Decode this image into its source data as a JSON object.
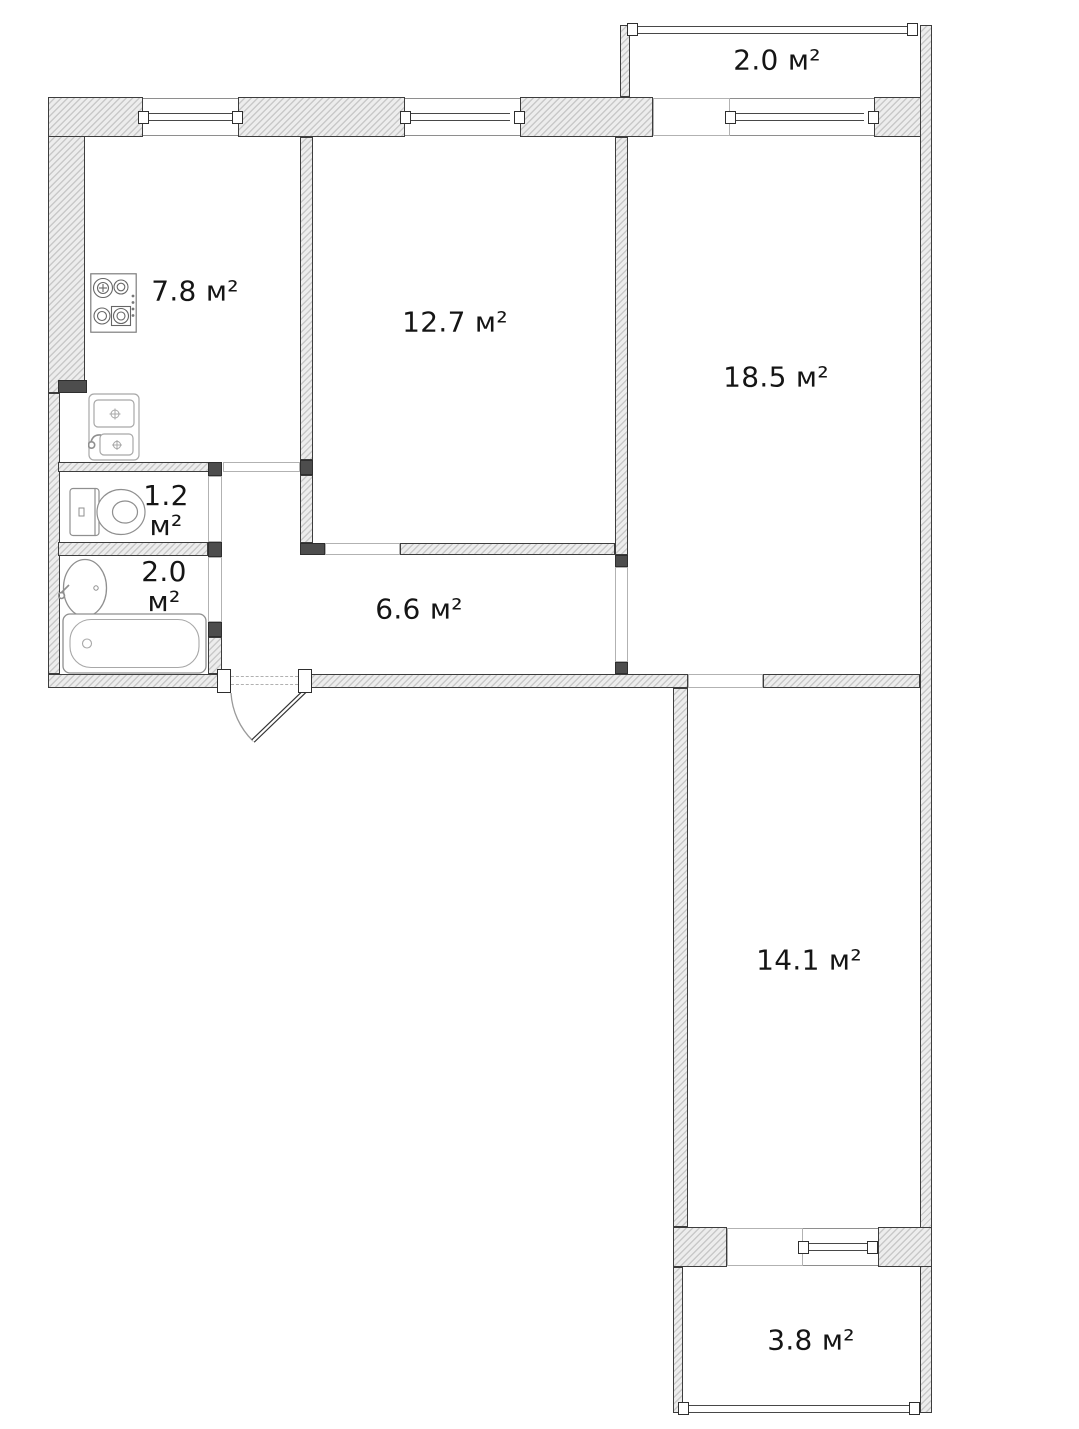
{
  "plan": {
    "kind": "apartment-floor-plan",
    "area_unit": "м²"
  },
  "rooms": [
    {
      "id": "kitchen",
      "area_label": "7.8 м²"
    },
    {
      "id": "room-12-7",
      "area_label": "12.7 м²"
    },
    {
      "id": "balcony-top",
      "area_label": "2.0 м²"
    },
    {
      "id": "room-18-5",
      "area_label": "18.5 м²"
    },
    {
      "id": "wc",
      "area_value": "1.2",
      "area_unit": "м²"
    },
    {
      "id": "bathroom",
      "area_value": "2.0",
      "area_unit": "м²"
    },
    {
      "id": "hallway",
      "area_label": "6.6 м²"
    },
    {
      "id": "room-14-1",
      "area_label": "14.1 м²"
    },
    {
      "id": "balcony-bottom",
      "area_label": "3.8 м²"
    }
  ],
  "fixtures": {
    "stove": "stove-icon",
    "kitchen_sink": "kitchen-sink-icon",
    "toilet": "toilet-icon",
    "washbasin": "washbasin-icon",
    "bathtub": "bathtub-icon",
    "entrance": "entrance-door-swing"
  },
  "colors": {
    "wall_fill": "#ededed",
    "wall_hatch_line": "#c9c9c9",
    "wall_border": "#3d3d3d",
    "jamb_fill": "#4d4d4d",
    "glazing_line": "#474747",
    "opening_line": "#b2b2b2",
    "fixture_stroke": "#9a9a9a",
    "text": "#151515",
    "background": "#ffffff"
  }
}
